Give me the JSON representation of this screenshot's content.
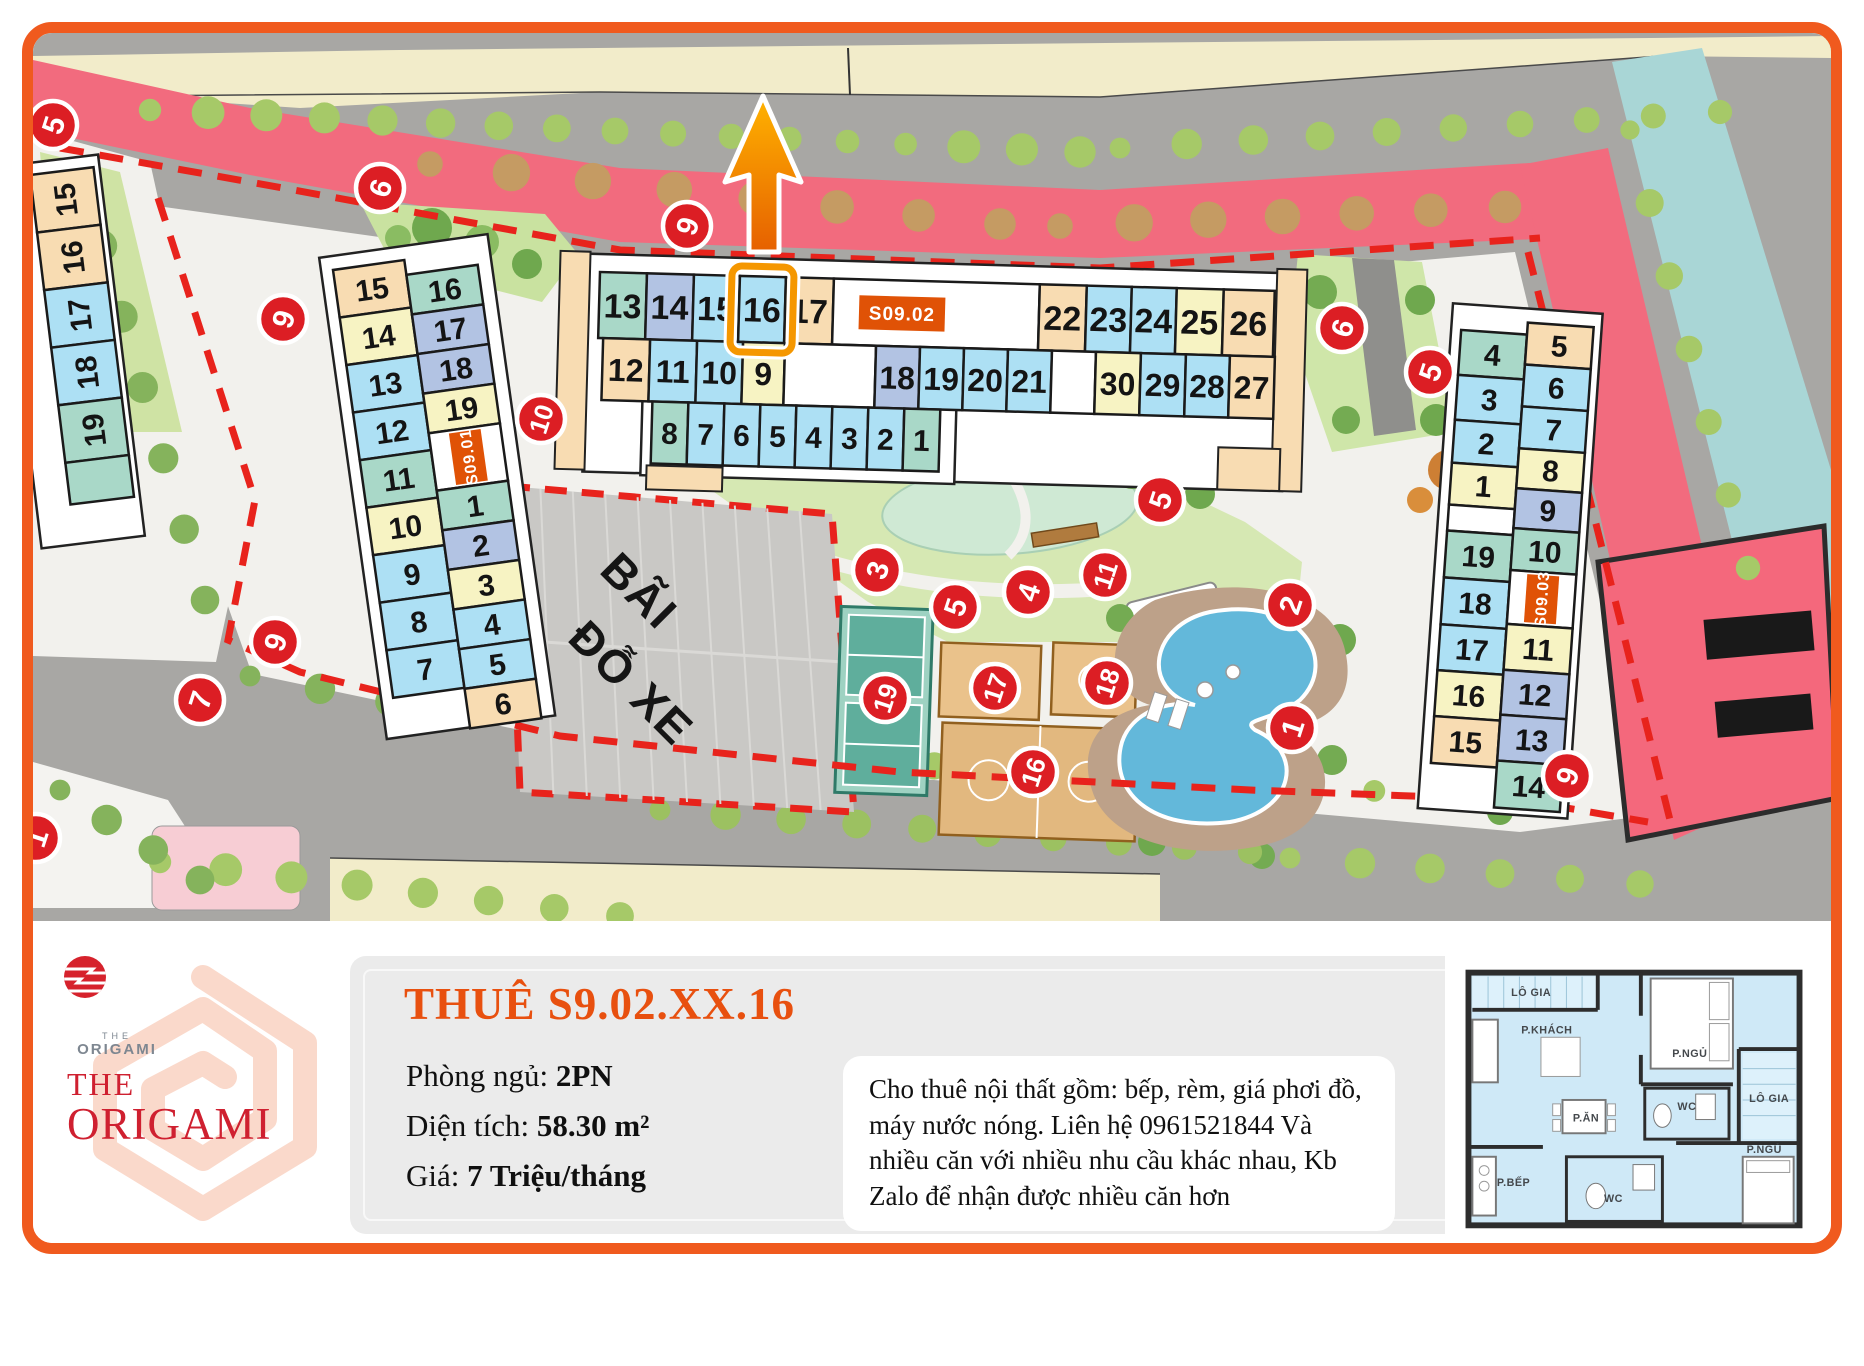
{
  "colors": {
    "frame": "#f05a1e",
    "marker_red": "#dc1e24",
    "badge_orange": "#e05206",
    "highlight_orange": "#f59700",
    "cell_palette": {
      "blue": "#ade0f4",
      "yellow": "#f7f3c3",
      "tan": "#f8dcb2",
      "teal": "#a9d8c8",
      "peri": "#b2c3e3",
      "white": "#ffffff"
    }
  },
  "map": {
    "parking_label": [
      "BÃI",
      "ĐỖ XE"
    ],
    "highlight_unit": "16",
    "buildings": [
      {
        "label": "S09.01",
        "columns": [
          {
            "cells": [
              "15:tan",
              "14:yellow",
              "13:blue",
              "12:blue",
              "11:teal",
              "10:yellow",
              "9:blue",
              "8:blue",
              "7:blue"
            ]
          },
          {
            "cells": [
              "16:teal",
              "17:peri",
              "18:peri",
              "19:yellow",
              "BADGE",
              "1:teal",
              "2:peri",
              "3:yellow",
              "4:blue",
              "5:blue",
              "6:tan"
            ]
          }
        ]
      },
      {
        "label": "S09.02",
        "rows": [
          [
            "13:teal",
            "14:peri",
            "15:blue",
            "16:blue:HL",
            "17:tan",
            "GAPB",
            "22:tan",
            "23:blue",
            "24:blue",
            "25:yellow",
            "26:tan"
          ],
          [
            "12:tan",
            "11:blue",
            "10:blue",
            "9:yellow",
            "GAP",
            "18:peri",
            "19:blue",
            "20:blue",
            "21:blue",
            "GAP",
            "30:yellow",
            "29:blue",
            "28:blue",
            "27:tan"
          ],
          [
            "8:teal",
            "7:blue",
            "6:blue",
            "5:blue",
            "4:blue",
            "3:blue",
            "2:blue",
            "1:teal"
          ]
        ]
      },
      {
        "label": "S09.03",
        "columns": [
          {
            "cells": [
              "4:teal",
              "3:blue",
              "2:blue",
              "1:yellow",
              "GAP",
              "19:teal",
              "18:blue",
              "17:blue",
              "16:yellow",
              "15:tan"
            ]
          },
          {
            "cells": [
              "5:tan",
              "6:blue",
              "7:blue",
              "8:yellow",
              "9:peri",
              "10:teal",
              "BADGE",
              "11:yellow",
              "12:peri",
              "13:peri",
              "14:teal"
            ]
          }
        ]
      },
      {
        "label": "",
        "columns": [
          {
            "cells": [
              "15:tan",
              "16:tan",
              "17:blue",
              "18:blue",
              "19:teal",
              "-:teal"
            ]
          }
        ]
      }
    ],
    "markers": [
      {
        "n": "5",
        "x": 53,
        "y": 125
      },
      {
        "n": "6",
        "x": 380,
        "y": 188
      },
      {
        "n": "9",
        "x": 283,
        "y": 319
      },
      {
        "n": "9",
        "x": 687,
        "y": 226
      },
      {
        "n": "10",
        "x": 541,
        "y": 419
      },
      {
        "n": "6",
        "x": 1342,
        "y": 328
      },
      {
        "n": "5",
        "x": 1430,
        "y": 372
      },
      {
        "n": "5",
        "x": 1160,
        "y": 500
      },
      {
        "n": "3",
        "x": 877,
        "y": 570
      },
      {
        "n": "5",
        "x": 955,
        "y": 607
      },
      {
        "n": "4",
        "x": 1028,
        "y": 592
      },
      {
        "n": "11",
        "x": 1105,
        "y": 575
      },
      {
        "n": "2",
        "x": 1290,
        "y": 605
      },
      {
        "n": "19",
        "x": 885,
        "y": 698
      },
      {
        "n": "17",
        "x": 995,
        "y": 688
      },
      {
        "n": "18",
        "x": 1107,
        "y": 683
      },
      {
        "n": "16",
        "x": 1033,
        "y": 772
      },
      {
        "n": "1",
        "x": 1292,
        "y": 728
      },
      {
        "n": "9",
        "x": 275,
        "y": 642
      },
      {
        "n": "7",
        "x": 200,
        "y": 700
      },
      {
        "n": "9",
        "x": 1567,
        "y": 776
      },
      {
        "n": "1",
        "x": 36,
        "y": 838
      }
    ]
  },
  "info": {
    "title": "THUÊ S9.02.XX.16",
    "specs": [
      {
        "label": "Phòng ngủ:",
        "value": "2PN"
      },
      {
        "label": "Diện tích:",
        "value": "58.30 m²"
      },
      {
        "label": "Giá:",
        "value": "7 Triệu/tháng"
      }
    ],
    "description": "Cho thuê nội thất gồm: bếp, rèm, giá phơi đồ, máy nước nóng. Liên hệ 0961521844 Và nhiều căn với nhiều nhu cầu khác nhau, Kb Zalo để nhận được nhiều căn hơn"
  },
  "logo": {
    "mark_top": "THE",
    "mark_name": "ORIGAMI",
    "line1": "THE",
    "line2": "ORIGAMI"
  },
  "floorplan": {
    "labels": [
      {
        "t": "LÔ GIA",
        "x": 84,
        "y": 42
      },
      {
        "t": "P.KHÁCH",
        "x": 100,
        "y": 80
      },
      {
        "t": "P.NGỦ",
        "x": 246,
        "y": 104
      },
      {
        "t": "WC",
        "x": 243,
        "y": 158
      },
      {
        "t": "LÔ GIA",
        "x": 327,
        "y": 150
      },
      {
        "t": "P.ĂN",
        "x": 140,
        "y": 170
      },
      {
        "t": "P.NGỦ",
        "x": 322,
        "y": 202
      },
      {
        "t": "P.BẾP",
        "x": 66,
        "y": 236
      },
      {
        "t": "WC",
        "x": 168,
        "y": 252
      }
    ]
  }
}
